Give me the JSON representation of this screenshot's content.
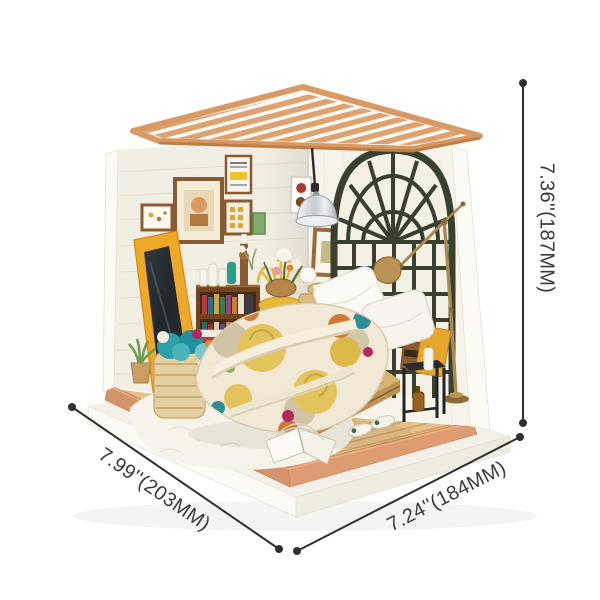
{
  "annotations": {
    "height_label": "7.36''(187MM)",
    "depth_label": "7.99''(203MM)",
    "width_label": "7.24''(184MM)"
  },
  "palette": {
    "background": "#ffffff",
    "annotation_text": "#3a3a3a",
    "annotation_line": "#2f2f2f",
    "roof_wood": "#dda26e",
    "wall_cream": "#f1eee3",
    "window_frame_dark": "#3a4030",
    "mirror_frame_yellow": "#efa829",
    "floor_wood": "#e5c08a",
    "base_trim_terracotta": "#d5936b",
    "bookshelf_brown": "#7a4c28",
    "bed_wood": "#d9b470",
    "quilt_yellow": "#e3c35c",
    "quilt_orange": "#d07c35",
    "quilt_teal": "#2e8f99",
    "quilt_magenta": "#b5285a",
    "pillow_white": "#f8f6ef",
    "lamp_brass": "#a98a52",
    "pendant_chrome": "#d9dbe0",
    "nightstand_black": "#26262b",
    "yarn_teal": "#2ba0ab",
    "wicker": "#e0c48e",
    "plant_green": "#6f9c4f",
    "chair_yellow": "#e8b83a"
  },
  "scene": {
    "parts": [
      "pergola-roof",
      "left-wall",
      "right-wall",
      "arched-window",
      "pendant-lamp",
      "floor-lamp",
      "standing-mirror",
      "bookshelf",
      "peacock-chair",
      "flower-basket",
      "yarn-basket",
      "potted-plant",
      "bed",
      "patchwork-quilt",
      "pillows",
      "nightstand",
      "slippers",
      "open-book",
      "fluffy-rug",
      "wood-floor",
      "display-base"
    ]
  }
}
